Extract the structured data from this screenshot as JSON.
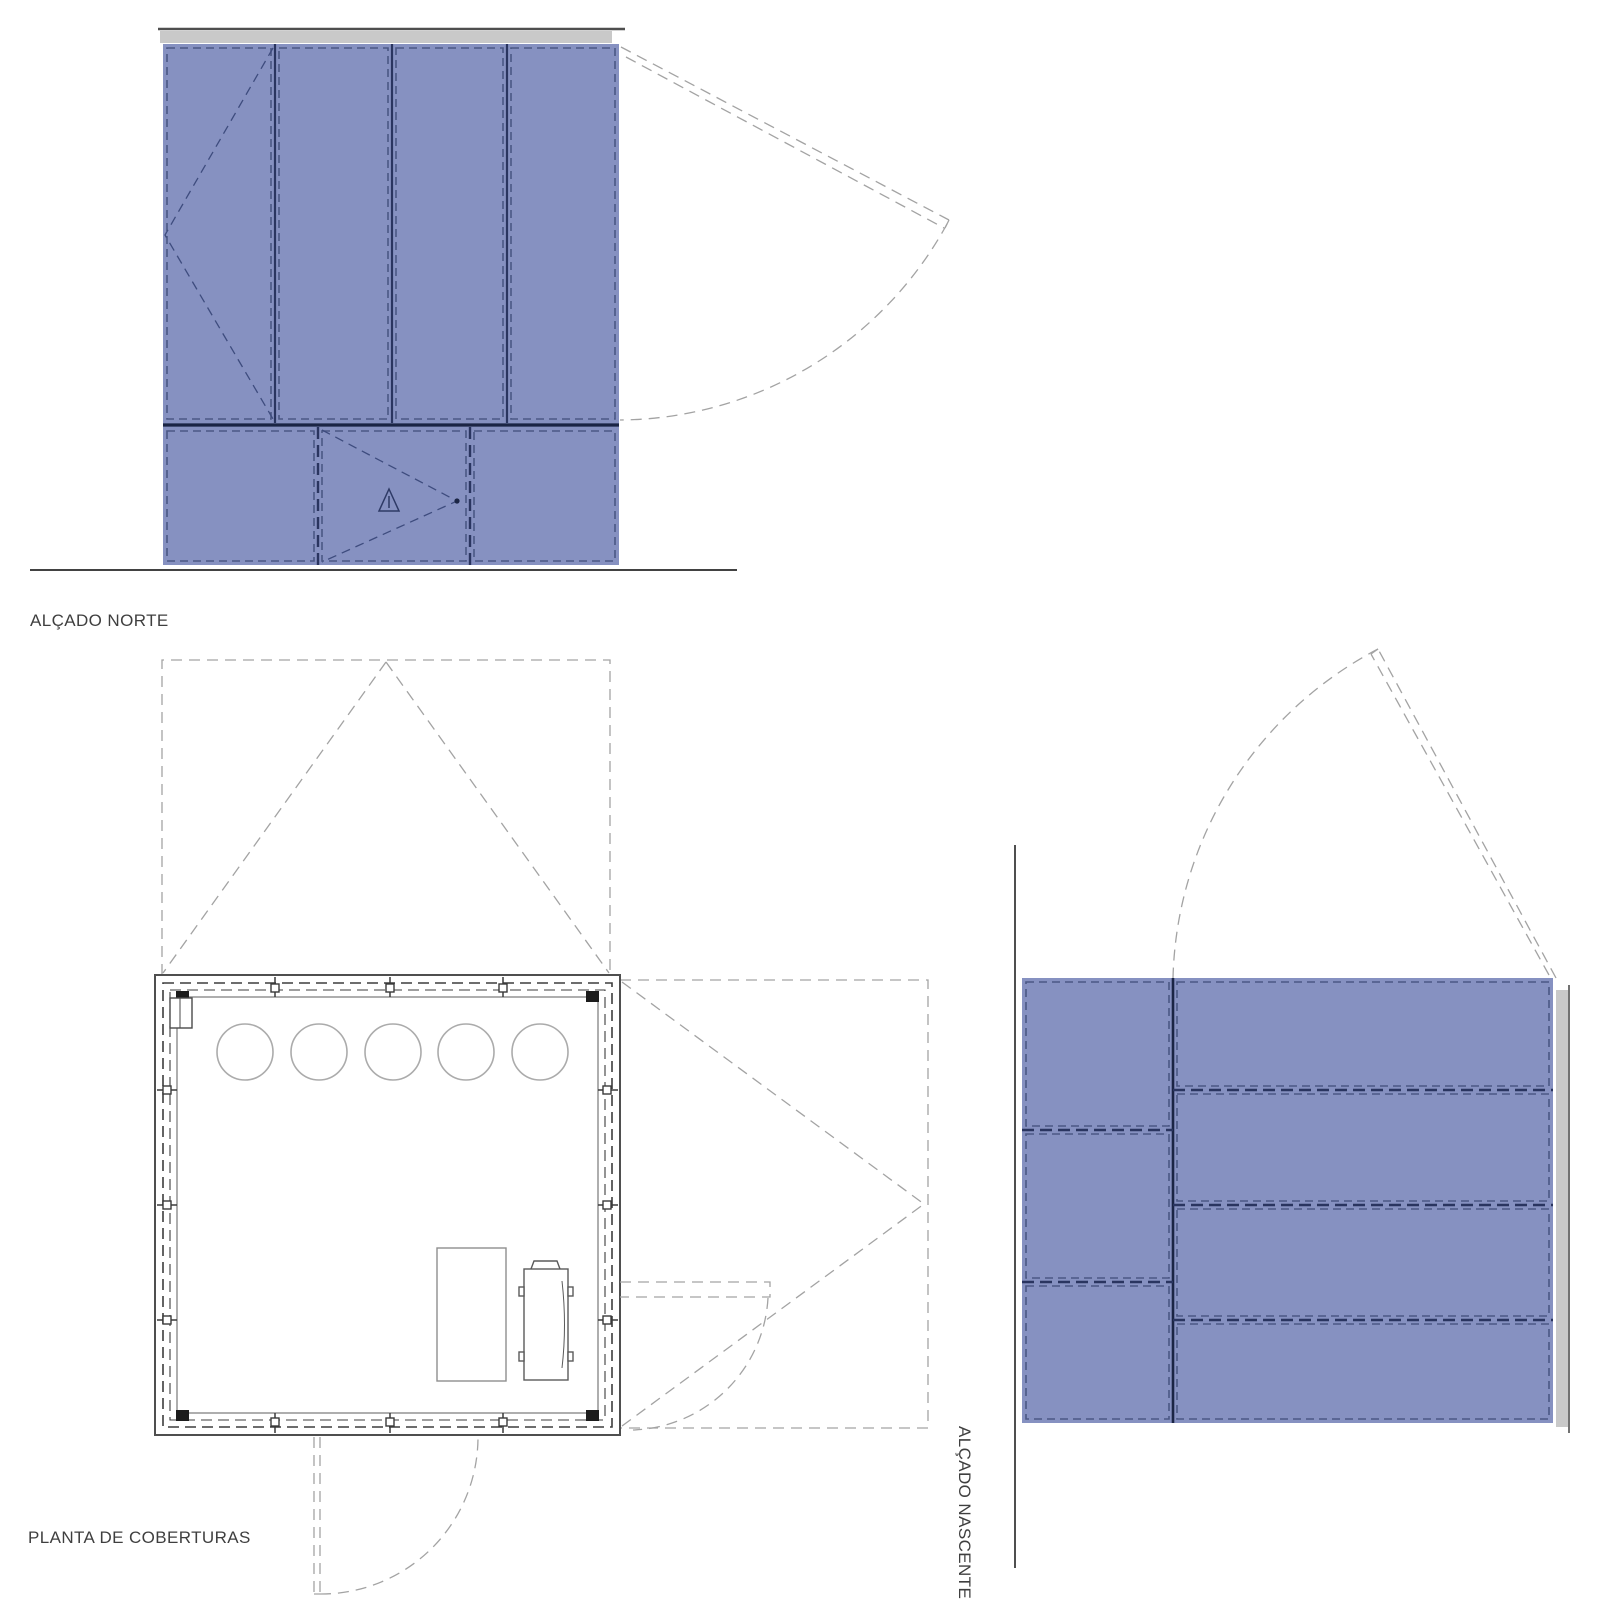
{
  "sheet": {
    "labels": {
      "north_elevation": "ALÇADO NORTE",
      "roof_plan": "PLANTA DE COBERTURAS",
      "east_elevation": "ALÇADO NASCENTE"
    },
    "views": {
      "north_elevation": {
        "type": "facade-elevation",
        "upper_vertical_panels": 4,
        "lower_horizontal_band_panels": 3,
        "symbols": [
          "window-opening-dashed-v-left-panel",
          "door-opening-dashed-v-lower-middle",
          "warning-triangle-glyph",
          "top-hung-door-swing-arc-right"
        ]
      },
      "roof_plan": {
        "type": "roof-plan",
        "skylight_circles": 5,
        "furniture": [
          "table-rectangle",
          "water-heater-appliance"
        ],
        "symbols": [
          "north-door-projection-triangle",
          "east-door-projection-rectangle",
          "south-door-swing-arc",
          "east-small-door-swing-arc"
        ]
      },
      "east_elevation": {
        "type": "facade-elevation",
        "left_column_rows": 3,
        "right_column_rows": 4,
        "symbols": [
          "top-hung-door-swing-arc",
          "roof-edge-gray-bar"
        ]
      }
    }
  },
  "colors": {
    "paper": "#ffffff",
    "facade_fill": "#8691c1",
    "facade_panel_dash": "#4b5885",
    "facade_divider": "#2a3560",
    "facade_section_line": "#1b2545",
    "roof_bar_gray": "#c9c9c9",
    "roof_bar_line": "#4f4f4f",
    "ground_line": "#424242",
    "projection_dash": "#a3a3a3",
    "plan_wall": "#4f4f4f",
    "plan_wall_inner": "#8c8c8c",
    "plan_wall_dash": "#3d3d3d",
    "skylight_stroke": "#ababab",
    "furniture_stroke": "#8f8f8f",
    "appliance_stroke": "#5a5a5a",
    "opening_dash": "#3e4c7e",
    "label_text": "#3f3f3f"
  }
}
